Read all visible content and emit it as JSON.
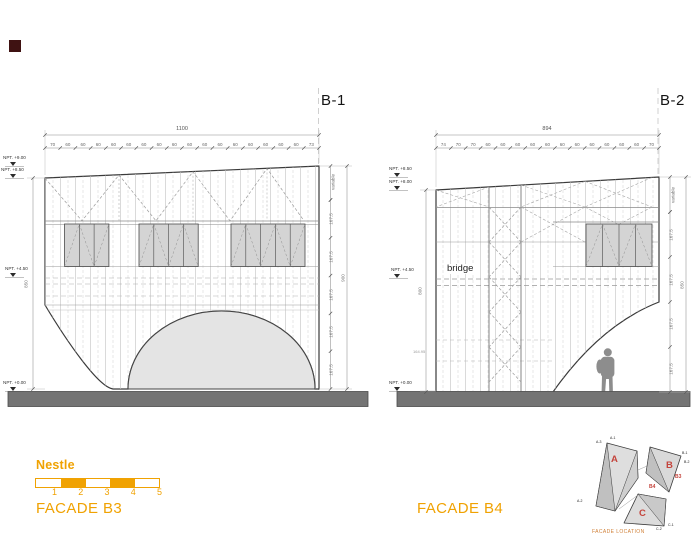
{
  "colors": {
    "accent": "#F0A202",
    "red": "#C4443C",
    "location_title": "#D08038"
  },
  "facade_b3": {
    "grid_ref": "B-1",
    "title": "FACADE B3",
    "width_total": "1100",
    "width_segments": [
      "70",
      "60",
      "60",
      "60",
      "60",
      "60",
      "60",
      "60",
      "60",
      "60",
      "60",
      "60",
      "60",
      "60",
      "60",
      "60",
      "60",
      "73"
    ],
    "levels": [
      "NPT. +9.00",
      "NPT. +8.50",
      "NPT. +4.50",
      "NPT. +0.00"
    ],
    "height_left": "850",
    "height_right_total": "900",
    "height_right_variable": "variable",
    "height_right_segments": [
      "167.5",
      "167.5",
      "167.5",
      "167.5",
      "167.5"
    ]
  },
  "facade_b4": {
    "grid_ref": "B-2",
    "title": "FACADE B4",
    "width_total": "894",
    "width_segments": [
      "74",
      "70",
      "70",
      "60",
      "60",
      "60",
      "60",
      "60",
      "60",
      "60",
      "60",
      "60",
      "60",
      "60",
      "70"
    ],
    "levels": [
      "NPT. +8.50",
      "NPT. +8.00",
      "NPT. +4.50",
      "NPT. +0.00"
    ],
    "height_left": "800",
    "height_right_total": "850",
    "height_right_variable": "variable",
    "height_right_segments": [
      "167.5",
      "167.5",
      "167.5",
      "167.5"
    ],
    "bridge_label": "bridge",
    "elevation_note": "164.95"
  },
  "legend": {
    "brand": "Nestle",
    "scale_numbers": [
      "1",
      "2",
      "3",
      "4",
      "5"
    ]
  },
  "location_diagram": {
    "title": "FACADE LOCATION",
    "volume_labels": [
      "A",
      "B",
      "C"
    ],
    "facade_refs": [
      "B3",
      "B4"
    ],
    "corner_labels": [
      "A-1",
      "A-2",
      "A-3",
      "B-1",
      "B-2",
      "C-1",
      "C-2"
    ]
  }
}
